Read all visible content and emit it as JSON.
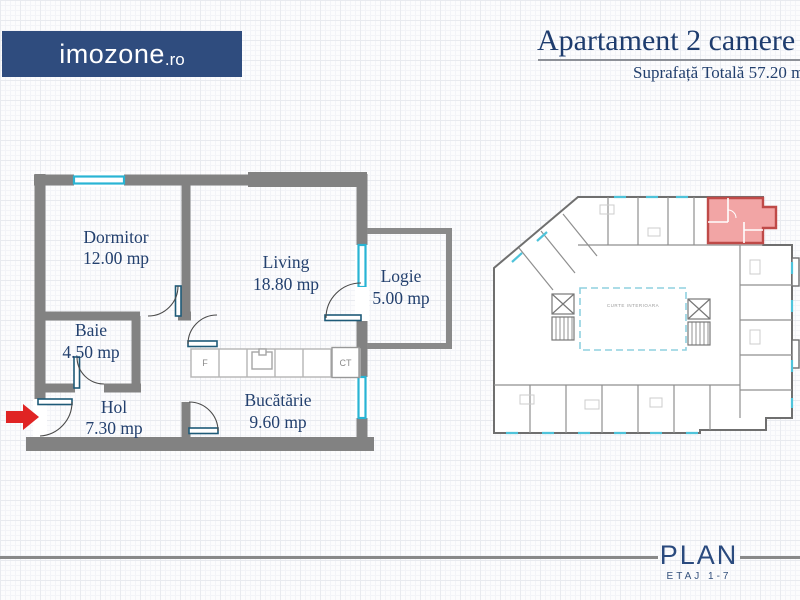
{
  "brand": {
    "name": "imozone",
    "tld": ".ro"
  },
  "header": {
    "title": "Apartament 2 camere",
    "subtitle": "Suprafață Totală 57.20 mp"
  },
  "plan": {
    "rooms": [
      {
        "name": "Dormitor",
        "area": "12.00 mp"
      },
      {
        "name": "Living",
        "area": "18.80 mp"
      },
      {
        "name": "Logie",
        "area": "5.00 mp"
      },
      {
        "name": "Baie",
        "area": "4.50 mp"
      },
      {
        "name": "Hol",
        "area": "7.30 mp"
      },
      {
        "name": "Bucătărie",
        "area": "9.60 mp"
      }
    ],
    "fixtures": {
      "fridge": "F",
      "boiler": "CT"
    }
  },
  "site_plan": {
    "courtyard": "CURTE INTERIOARA"
  },
  "footer": {
    "plan": "PLAN",
    "floors": "ETAJ 1-7"
  },
  "colors": {
    "brand_blue": "#2f4c7e",
    "text_navy": "#23406e",
    "wall_gray": "#828282",
    "window_cyan": "#29b4d4",
    "unit_highlight_fill": "#f2a5a5",
    "unit_highlight_stroke": "#bf4a48",
    "arrow_red": "#e02424"
  }
}
